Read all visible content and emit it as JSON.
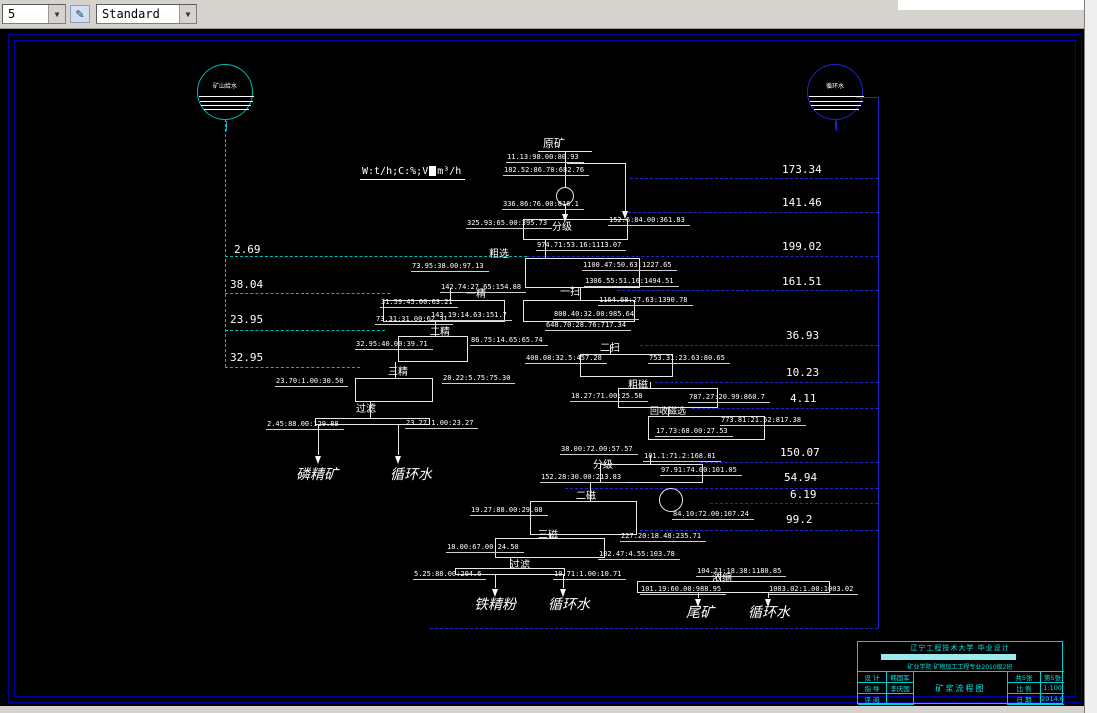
{
  "toolbar": {
    "layer_value": "5",
    "style_value": "Standard",
    "style_icon": "✎"
  },
  "legend": {
    "prefix": "W:t/h;C:%;V",
    "suffix": "m³/h"
  },
  "colors": {
    "cyan": "#00b8b8",
    "blue": "#2424cf",
    "white": "#e8e8e8",
    "frame_blue": "#0000a6",
    "title_cyan": "#00e5e5"
  },
  "tanks": [
    {
      "label": "矿山给水",
      "cx": 225,
      "cy": 92,
      "r": 28,
      "color": "#00b8b8"
    },
    {
      "label": "循环水",
      "cx": 835,
      "cy": 92,
      "r": 28,
      "color": "#2424cf"
    }
  ],
  "left_flow_values": [
    {
      "text": "2.69",
      "x": 234,
      "y": 244
    },
    {
      "text": "38.04",
      "x": 230,
      "y": 279
    },
    {
      "text": "23.95",
      "x": 230,
      "y": 314
    },
    {
      "text": "32.95",
      "x": 230,
      "y": 352
    }
  ],
  "right_flow_values": [
    {
      "text": "173.34",
      "x": 782,
      "y": 164
    },
    {
      "text": "141.46",
      "x": 782,
      "y": 197
    },
    {
      "text": "199.02",
      "x": 782,
      "y": 241
    },
    {
      "text": "161.51",
      "x": 782,
      "y": 276
    },
    {
      "text": "36.93",
      "x": 786,
      "y": 330
    },
    {
      "text": "10.23",
      "x": 786,
      "y": 367
    },
    {
      "text": "4.11",
      "x": 790,
      "y": 393
    },
    {
      "text": "150.07",
      "x": 780,
      "y": 447
    },
    {
      "text": "54.94",
      "x": 784,
      "y": 472
    },
    {
      "text": "6.19",
      "x": 790,
      "y": 489
    },
    {
      "text": "99.2",
      "x": 786,
      "y": 514
    }
  ],
  "equipment_labels": [
    {
      "text": "原矿",
      "x": 543,
      "y": 138,
      "size": 11
    },
    {
      "text": "分级",
      "x": 552,
      "y": 222,
      "size": 10
    },
    {
      "text": "粗选",
      "x": 489,
      "y": 249,
      "size": 10
    },
    {
      "text": "一精",
      "x": 466,
      "y": 289,
      "size": 10
    },
    {
      "text": "一扫",
      "x": 560,
      "y": 287,
      "size": 10
    },
    {
      "text": "二精",
      "x": 430,
      "y": 327,
      "size": 10
    },
    {
      "text": "二扫",
      "x": 600,
      "y": 343,
      "size": 10
    },
    {
      "text": "三精",
      "x": 388,
      "y": 367,
      "size": 10
    },
    {
      "text": "过滤",
      "x": 356,
      "y": 404,
      "size": 10
    },
    {
      "text": "粗磁",
      "x": 628,
      "y": 380,
      "size": 10
    },
    {
      "text": "回收磁选",
      "x": 650,
      "y": 407,
      "size": 9
    },
    {
      "text": "分级",
      "x": 593,
      "y": 460,
      "size": 10
    },
    {
      "text": "二磁",
      "x": 576,
      "y": 491,
      "size": 10
    },
    {
      "text": "三磁",
      "x": 538,
      "y": 530,
      "size": 10
    },
    {
      "text": "过滤",
      "x": 510,
      "y": 560,
      "size": 10
    },
    {
      "text": "浓缩",
      "x": 712,
      "y": 573,
      "size": 10
    }
  ],
  "product_labels": [
    {
      "text": "磷精矿",
      "x": 296,
      "y": 468
    },
    {
      "text": "循环水",
      "x": 390,
      "y": 468
    },
    {
      "text": "铁精粉",
      "x": 474,
      "y": 598
    },
    {
      "text": "循环水",
      "x": 548,
      "y": 598
    },
    {
      "text": "尾矿",
      "x": 686,
      "y": 606
    },
    {
      "text": "循环水",
      "x": 748,
      "y": 606
    }
  ],
  "stream_annotations": [
    {
      "text": "11.13:98.00:80.93",
      "x": 506,
      "y": 153
    },
    {
      "text": "182.52:86.70:682.76",
      "x": 503,
      "y": 166
    },
    {
      "text": "336.86:76.00:816.1",
      "x": 502,
      "y": 200
    },
    {
      "text": "152.6:84.00:361.83",
      "x": 608,
      "y": 216
    },
    {
      "text": "325.93:65.00:395.73",
      "x": 466,
      "y": 219
    },
    {
      "text": "974.71:53.16:1113.07",
      "x": 536,
      "y": 241
    },
    {
      "text": "73.95:38.00:97.13",
      "x": 411,
      "y": 262
    },
    {
      "text": "1100.47:50.63:1227.65",
      "x": 582,
      "y": 261
    },
    {
      "text": "1306.55:51.16:1494.51",
      "x": 584,
      "y": 277
    },
    {
      "text": "142.74:27.65:154.88",
      "x": 440,
      "y": 283
    },
    {
      "text": "31.59:45.00:63.21",
      "x": 380,
      "y": 298
    },
    {
      "text": "1164.68:27.63:1390.78",
      "x": 598,
      "y": 296
    },
    {
      "text": "73.31:31.00:62.31",
      "x": 375,
      "y": 315
    },
    {
      "text": "143.19:14.63:151.7",
      "x": 430,
      "y": 311
    },
    {
      "text": "808.40:32.00:985.64",
      "x": 553,
      "y": 310
    },
    {
      "text": "648.70:28.76:717.34",
      "x": 545,
      "y": 321
    },
    {
      "text": "32.95:40.00:39.71",
      "x": 355,
      "y": 340
    },
    {
      "text": "86.75:14.65:65.74",
      "x": 470,
      "y": 336
    },
    {
      "text": "408.08:32.5:457.28",
      "x": 525,
      "y": 354
    },
    {
      "text": "753.31:23.63:80.65",
      "x": 648,
      "y": 354
    },
    {
      "text": "23.70:1.00:30.50",
      "x": 275,
      "y": 377
    },
    {
      "text": "28.22:5.75:75.30",
      "x": 442,
      "y": 374
    },
    {
      "text": "18.27:71.00:25.58",
      "x": 570,
      "y": 392
    },
    {
      "text": "787.27:20.99:860.7",
      "x": 688,
      "y": 393
    },
    {
      "text": "773.81:21.52:817.38",
      "x": 720,
      "y": 416
    },
    {
      "text": "17.73:68.00:27.53",
      "x": 655,
      "y": 427
    },
    {
      "text": "2.45:88.00:129.88",
      "x": 266,
      "y": 420
    },
    {
      "text": "23.27:1.00:23.27",
      "x": 405,
      "y": 419
    },
    {
      "text": "38.00:72.00:57.57",
      "x": 560,
      "y": 445
    },
    {
      "text": "101.1:71.2:168.81",
      "x": 643,
      "y": 452
    },
    {
      "text": "97.91:74.00:101.05",
      "x": 660,
      "y": 466
    },
    {
      "text": "152.28:30.00:213.83",
      "x": 540,
      "y": 473
    },
    {
      "text": "19.27:88.00:29.08",
      "x": 470,
      "y": 506
    },
    {
      "text": "84.10:72.00:107.24",
      "x": 672,
      "y": 510
    },
    {
      "text": "227.20:18.48:235.71",
      "x": 620,
      "y": 532
    },
    {
      "text": "18.00:67.00:24.50",
      "x": 446,
      "y": 543
    },
    {
      "text": "102.47:4.55:103.78",
      "x": 598,
      "y": 550
    },
    {
      "text": "5.25:88.00:204.6",
      "x": 413,
      "y": 570
    },
    {
      "text": "10.71:1.00:10.71",
      "x": 553,
      "y": 570
    },
    {
      "text": "104.21:18.38:1180.85",
      "x": 696,
      "y": 567
    },
    {
      "text": "101.19:60.00:988.95",
      "x": 640,
      "y": 585
    },
    {
      "text": "1003.02:1.00:1003.02",
      "x": 768,
      "y": 585
    }
  ],
  "title_block": {
    "university_line": "辽宁工程技术大学 毕业设计",
    "department_line": "矿业学院  矿物加工工程专业2010级2班",
    "drawing_title": "矿浆流程图",
    "rows": [
      {
        "label": "设 计",
        "value": "韩国军"
      },
      {
        "label": "指 导",
        "value": "李庆国"
      },
      {
        "label": "评 阅",
        "value": ""
      }
    ],
    "right_rows": [
      {
        "label": "共5张",
        "value": "第5张"
      },
      {
        "label": "比 例",
        "value": "1:100"
      },
      {
        "label": "日 期",
        "value": "2014.6"
      }
    ]
  }
}
